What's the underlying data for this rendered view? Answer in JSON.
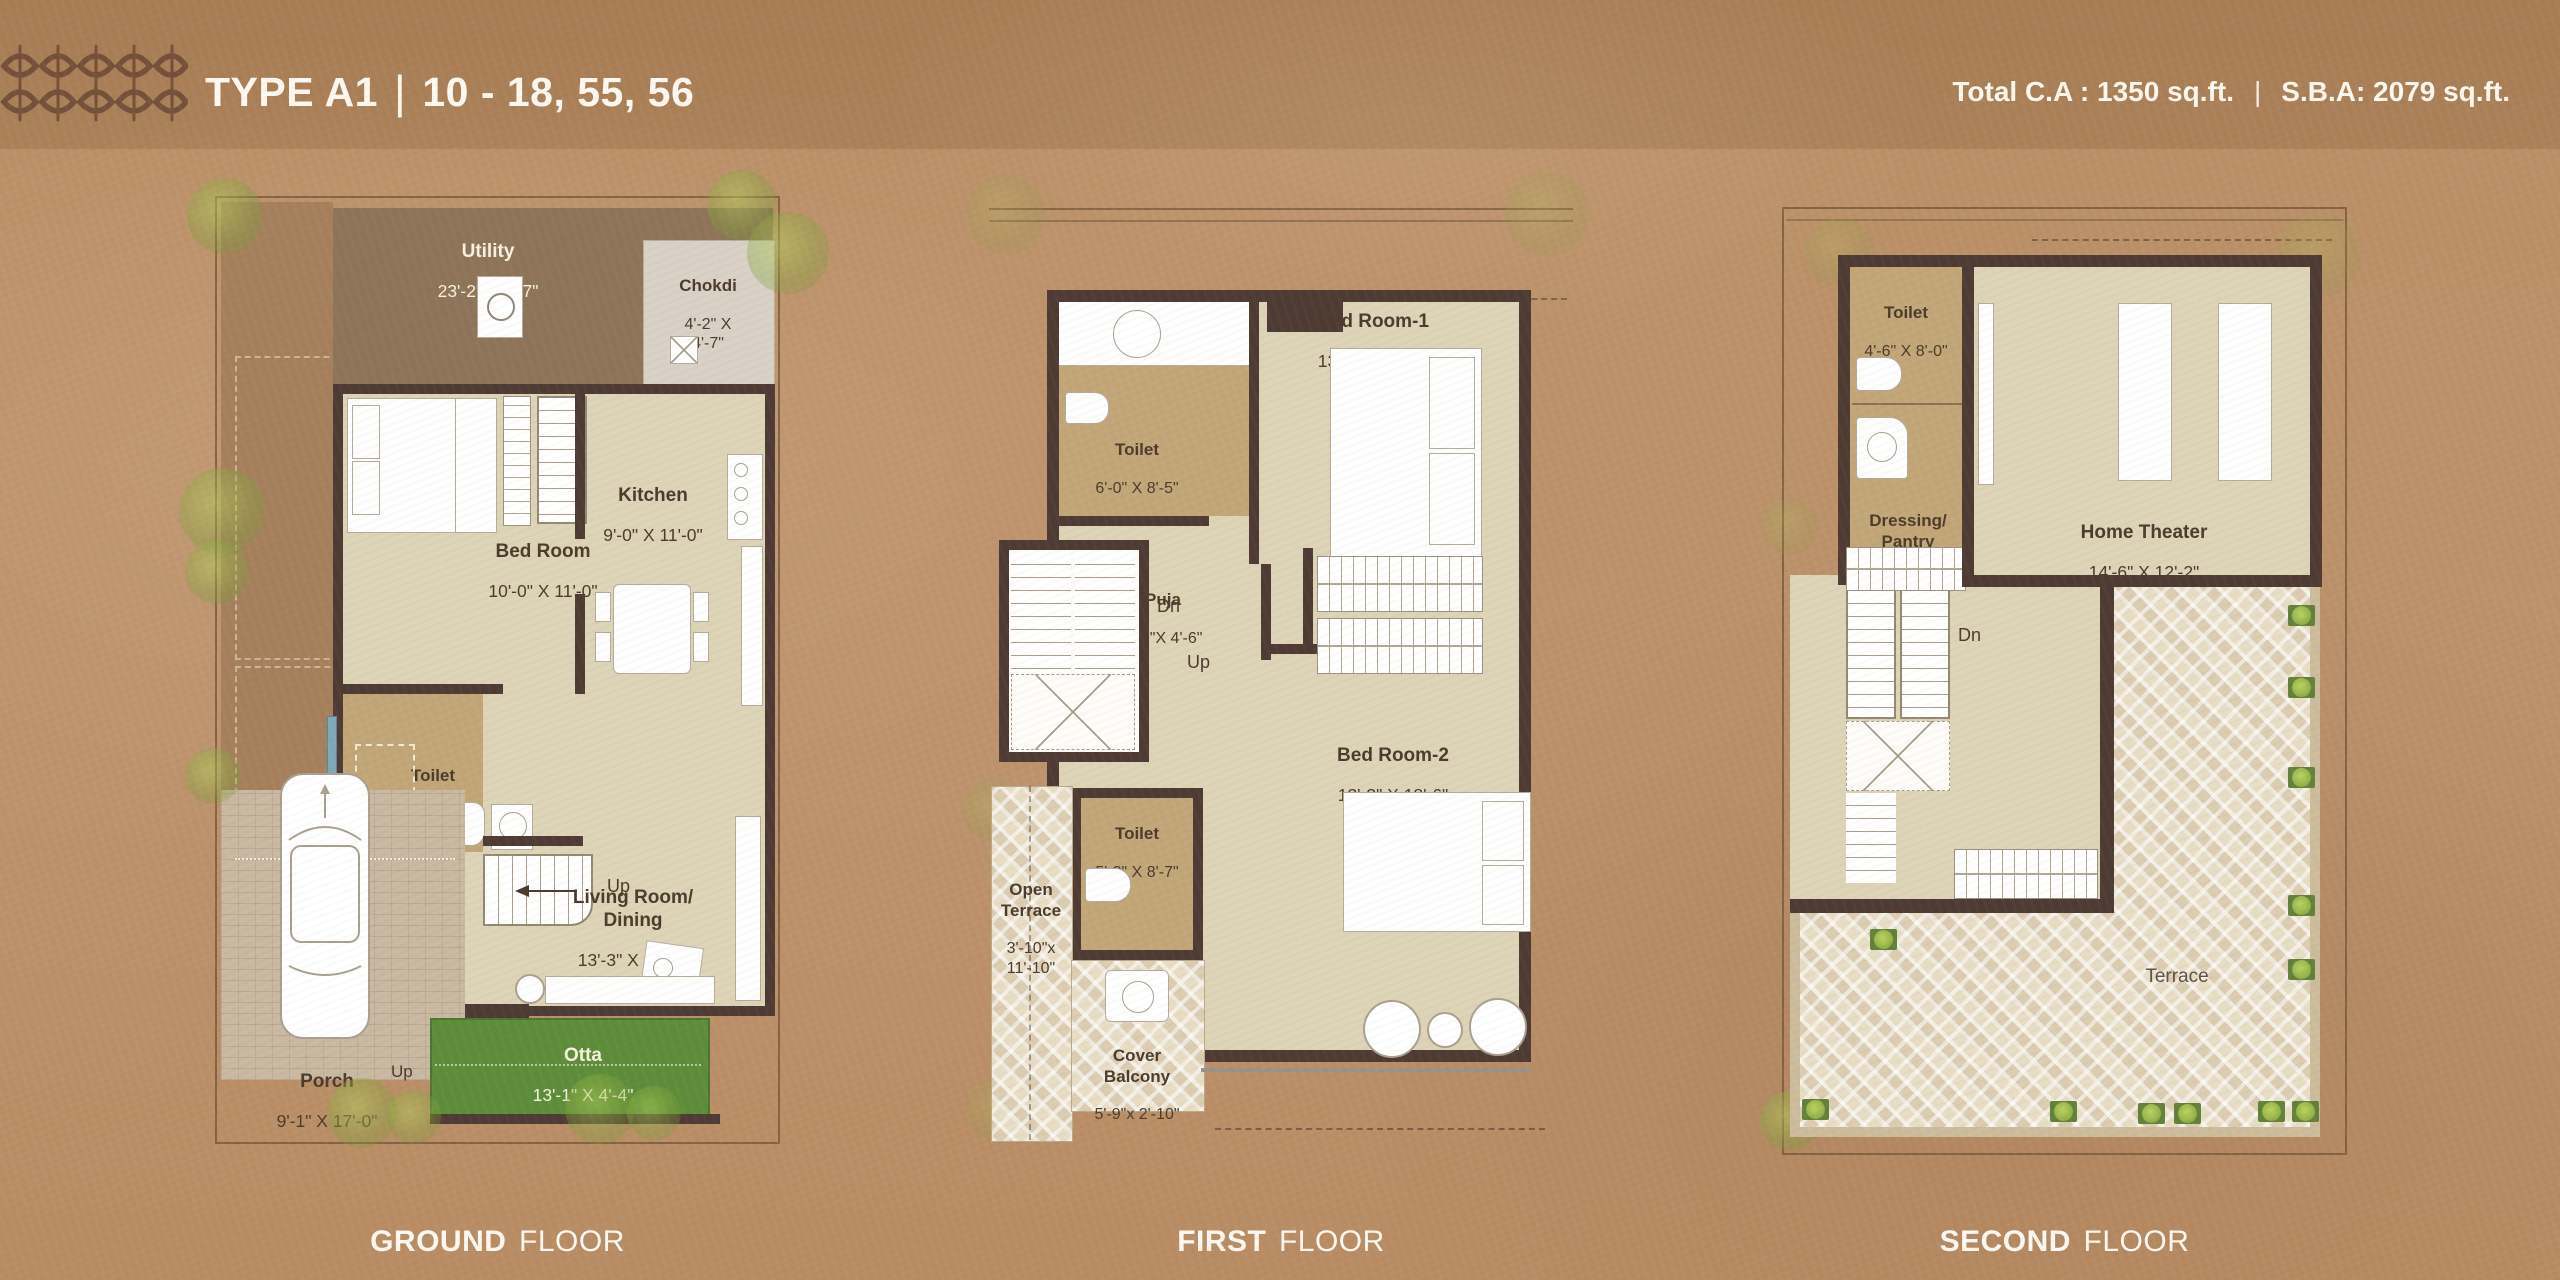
{
  "header": {
    "logo": "floral-tile-pattern",
    "title_type": "TYPE A1",
    "title_sep": "|",
    "title_units": "10 - 18, 55, 56",
    "stats_left": "Total C.A : 1350 sq.ft.",
    "stats_sep": "|",
    "stats_right": "S.B.A: 2079 sq.ft."
  },
  "colors": {
    "background_kraft": "#bb9068",
    "wall_dark": "#4e3b33",
    "room_beige": "#ddd3b6",
    "toilet_tan": "#c2a678",
    "otta_green": "#5d8d3a",
    "tree_green": "#9cb551",
    "terrace_cream": "#e7dcc4",
    "text_dark": "#4c3b2c",
    "text_light": "#f7f1e0"
  },
  "floors": [
    {
      "id": "ground",
      "caption_bold": "GROUND",
      "caption_rest": "FLOOR",
      "rooms": {
        "utility": {
          "name": "Utility",
          "dims": "23'-2\" X 4'-7\""
        },
        "chokdi": {
          "name": "Chokdi",
          "dims": "4'-2\" X 4'-7\""
        },
        "bedroom": {
          "name": "Bed Room",
          "dims": "10'-0\" X 11'-0\""
        },
        "kitchen": {
          "name": "Kitchen",
          "dims": "9'-0\" X 11'-0\""
        },
        "toilet": {
          "name": "Toilet",
          "dims": "5'-9\" X\n4'-11\""
        },
        "living": {
          "name": "Living Room/\nDining",
          "dims": "13'-3\" X 17'-3\""
        },
        "otta": {
          "name": "Otta",
          "dims": "13'-1\" X 4'-4\""
        },
        "porch": {
          "name": "Porch",
          "dims": "9'-1\" X 17'-0\""
        }
      },
      "labels": {
        "up_stairs": "Up",
        "up_otta": "Up"
      }
    },
    {
      "id": "first",
      "caption_bold": "FIRST",
      "caption_rest": "FLOOR",
      "rooms": {
        "toilet_top": {
          "name": "Toilet",
          "dims": "6'-0\" X 8'-5\""
        },
        "puja": {
          "name": "Puja",
          "dims": "6'-0\"X 4'-6\""
        },
        "bedroom1": {
          "name": "Bed Room-1",
          "dims": "13'-0\" X 14'-7\""
        },
        "bedroom2": {
          "name": "Bed Room-2",
          "dims": "13'-3\" X 18'-6\""
        },
        "toilet_bottom": {
          "name": "Toilet",
          "dims": "5'-3\" X 8'-7\""
        },
        "open_terrace": {
          "name": "Open\nTerrace",
          "dims": "3'-10\"x\n11'-10\""
        },
        "cover_balcony": {
          "name": "Cover\nBalcony",
          "dims": "5'-9\"x 2'-10\""
        }
      },
      "labels": {
        "dn": "Dn",
        "up": "Up"
      }
    },
    {
      "id": "second",
      "caption_bold": "SECOND",
      "caption_rest": "FLOOR",
      "rooms": {
        "toilet": {
          "name": "Toilet",
          "dims": "4'-6\" X 8'-0\""
        },
        "dressing": {
          "name": "Dressing/\nPantry",
          "dims": "4'-6\" X 5'-0\""
        },
        "home_theater": {
          "name": "Home Theater",
          "dims": "14'-6\" X 12'-2\""
        },
        "terrace": {
          "name": "Terrace",
          "dims": ""
        }
      },
      "labels": {
        "dn": "Dn"
      }
    }
  ]
}
